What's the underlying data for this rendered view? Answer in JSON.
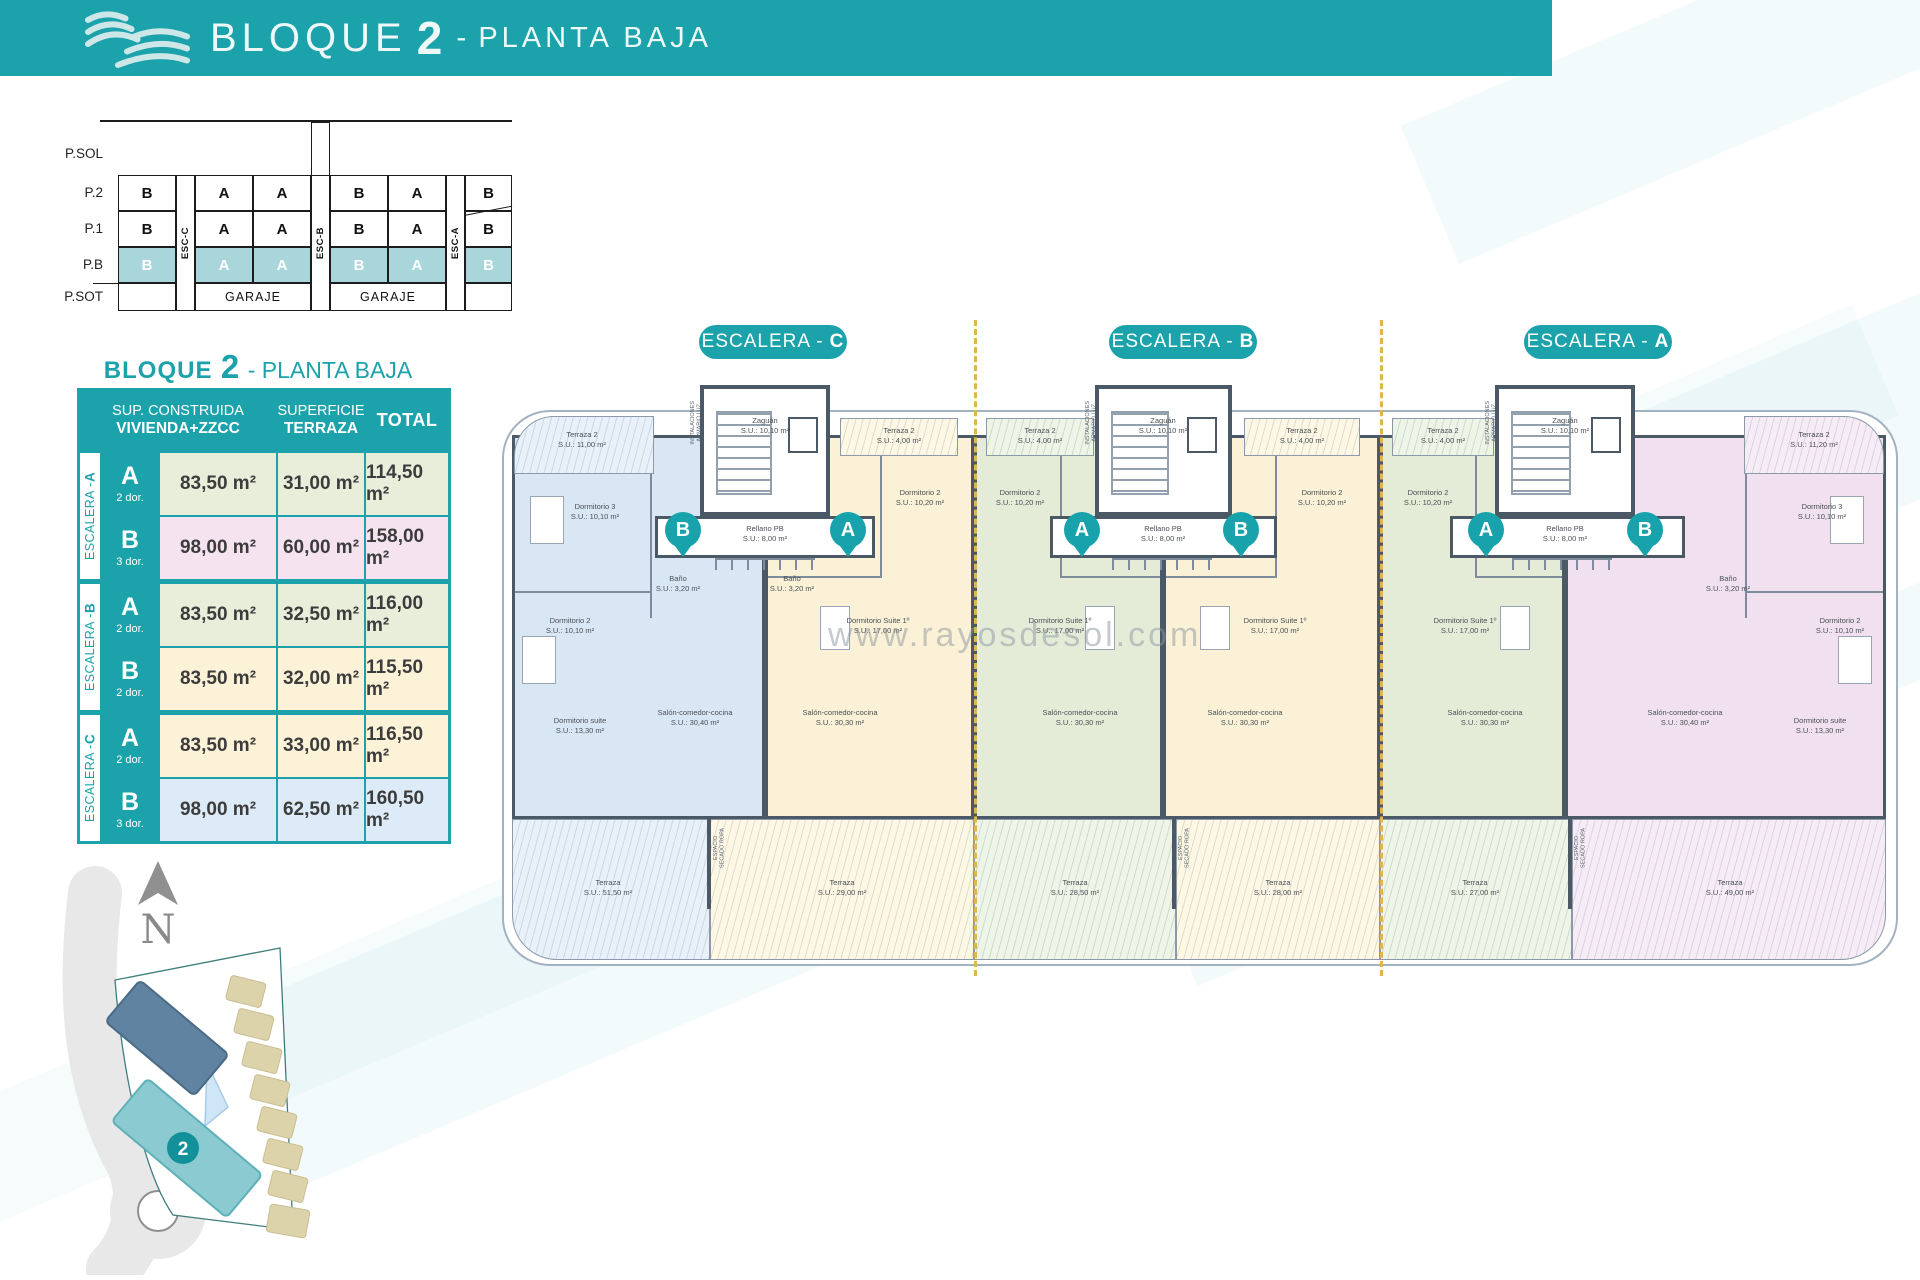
{
  "header": {
    "title_block": "BLOQUE",
    "title_number": "2",
    "title_dash": "-",
    "title_floor": "PLANTA BAJA"
  },
  "stack_diagram": {
    "floors": [
      "P.SOL",
      "P.2",
      "P.1",
      "P.B",
      "P.SOT"
    ],
    "esc_columns": [
      "ESC-C",
      "ESC-B",
      "ESC-A"
    ],
    "rows": {
      "p2": [
        "B",
        "A",
        "A",
        "B",
        "A",
        "B"
      ],
      "p1": [
        "B",
        "A",
        "A",
        "B",
        "A",
        "B"
      ],
      "pb": [
        "B",
        "A",
        "A",
        "B",
        "A",
        "B"
      ]
    },
    "garaje_left": "GARAJE",
    "garaje_right": "GARAJE"
  },
  "summary_table": {
    "title_block": "BLOQUE",
    "title_number": "2",
    "title_floor": "- PLANTA BAJA",
    "col1_line1": "SUP. CONSTRUIDA",
    "col1_line2": "VIVIENDA+ZZCC",
    "col2_line1": "SUPERFICIE",
    "col2_line2": "TERRAZA",
    "col3": "TOTAL",
    "groups": [
      {
        "label_prefix": "ESCALERA - ",
        "label_letter": "A",
        "rows": [
          {
            "letter": "A",
            "dorms": "2 dor.",
            "built": "83,50 m²",
            "terrace": "31,00 m²",
            "total": "114,50 m²"
          },
          {
            "letter": "B",
            "dorms": "3 dor.",
            "built": "98,00 m²",
            "terrace": "60,00 m²",
            "total": "158,00 m²"
          }
        ]
      },
      {
        "label_prefix": "ESCALERA - ",
        "label_letter": "B",
        "rows": [
          {
            "letter": "A",
            "dorms": "2 dor.",
            "built": "83,50 m²",
            "terrace": "32,50 m²",
            "total": "116,00 m²"
          },
          {
            "letter": "B",
            "dorms": "2 dor.",
            "built": "83,50 m²",
            "terrace": "32,00 m²",
            "total": "115,50 m²"
          }
        ]
      },
      {
        "label_prefix": "ESCALERA - ",
        "label_letter": "C",
        "rows": [
          {
            "letter": "A",
            "dorms": "2 dor.",
            "built": "83,50 m²",
            "terrace": "33,00 m²",
            "total": "116,50 m²"
          },
          {
            "letter": "B",
            "dorms": "3 dor.",
            "built": "98,00 m²",
            "terrace": "62,50 m²",
            "total": "160,50 m²"
          }
        ]
      }
    ]
  },
  "plan": {
    "pills": [
      {
        "prefix": "ESCALERA -",
        "letter": "C"
      },
      {
        "prefix": "ESCALERA -",
        "letter": "B"
      },
      {
        "prefix": "ESCALERA -",
        "letter": "A"
      }
    ],
    "pins": {
      "c_left": "B",
      "c_right": "A",
      "b_left": "A",
      "b_right": "B",
      "a_left": "A",
      "a_right": "B"
    },
    "watermark": "www.rayosdesol.com",
    "core": {
      "zaguan": "Zaguán\nS.U.: 10,10 m²",
      "rellano": "Rellano PB\nS.U.: 8,00 m²",
      "instalaciones": "INSTALACIONES\nARMARIO LUZ",
      "secado": "ESPACIO\nSECADO ROPA"
    },
    "apartments": {
      "c_b": {
        "terraza2": "Terraza 2\nS.U.: 11,00 m²",
        "dorm3": "Dormitorio 3\nS.U.: 10,10 m²",
        "bano": "Baño\nS.U.: 3,20 m²",
        "dorm2": "Dormitorio 2\nS.U.: 10,10 m²",
        "suite": "Dormitorio suite\nS.U.: 13,30 m²",
        "salon": "Salón-comedor-cocina\nS.U.: 30,40 m²",
        "terraza": "Terraza\nS.U.: 51,50 m²"
      },
      "c_a": {
        "terraza2": "Terraza 2\nS.U.: 4,00 m²",
        "dorm2": "Dormitorio 2\nS.U.: 10,20 m²",
        "bano": "Baño\nS.U.: 3,20 m²",
        "suite": "Dormitorio Suite 1º\nS.U.: 17,00 m²",
        "salon": "Salón-comedor-cocina\nS.U.: 30,30 m²",
        "terraza": "Terraza\nS.U.: 29,00 m²"
      },
      "b_a": {
        "terraza2": "Terraza 2\nS.U.: 4,00 m²",
        "dorm2": "Dormitorio 2\nS.U.: 10,20 m²",
        "suite": "Dormitorio Suite 1º\nS.U.: 17,00 m²",
        "salon": "Salón-comedor-cocina\nS.U.: 30,30 m²",
        "terraza": "Terraza\nS.U.: 28,50 m²"
      },
      "b_b": {
        "terraza2": "Terraza 2\nS.U.: 4,00 m²",
        "dorm2": "Dormitorio 2\nS.U.: 10,20 m²",
        "suite": "Dormitorio Suite 1º\nS.U.: 17,00 m²",
        "salon": "Salón-comedor-cocina\nS.U.: 30,30 m²",
        "terraza": "Terraza\nS.U.: 28,00 m²"
      },
      "a_a": {
        "terraza2": "Terraza 2\nS.U.: 4,00 m²",
        "dorm2": "Dormitorio 2\nS.U.: 10,20 m²",
        "suite": "Dormitorio Suite 1º\nS.U.: 17,00 m²",
        "salon": "Salón-comedor-cocina\nS.U.: 30,30 m²",
        "terraza": "Terraza\nS.U.: 27,00 m²"
      },
      "a_b": {
        "terraza2": "Terraza 2\nS.U.: 11,20 m²",
        "dorm3": "Dormitorio 3\nS.U.: 10,10 m²",
        "bano": "Baño\nS.U.: 3,20 m²",
        "dorm2": "Dormitorio 2\nS.U.: 10,10 m²",
        "suite": "Dormitorio suite\nS.U.: 13,30 m²",
        "salon": "Salón-comedor-cocina\nS.U.: 30,40 m²",
        "terraza": "Terraza\nS.U.: 49,00 m²"
      }
    }
  },
  "sitemap": {
    "north": "N",
    "badge": "2"
  }
}
